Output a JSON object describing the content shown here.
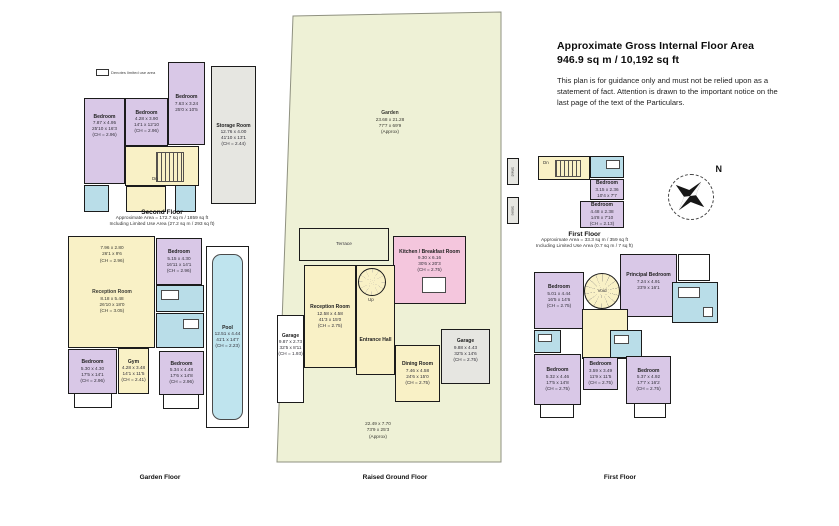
{
  "header": {
    "title_line1": "Approximate Gross Internal Floor Area",
    "title_line2": "946.9 sq m / 10,192 sq ft",
    "disclaimer": "This plan is for guidance only and must not be relied upon as a statement of fact. Attention is drawn to the important notice on the last page of the text of the Particulars."
  },
  "legend": {
    "label": "Denotes limited use area"
  },
  "compass": {
    "north": "N"
  },
  "colors": {
    "bedroom": "#d9c8e7",
    "living": "#f9f1c6",
    "bathroom": "#b9dde8",
    "kitchen": "#f4c6dd",
    "garden": "#eef1d6",
    "storage": "#e6e6e1",
    "pool": "#bfe4ee",
    "wall": "#1b1b1b"
  },
  "floors": {
    "second_floor": {
      "title": "Second Floor",
      "area1": "Approximate Area = 172.7 sq m / 1859 sq ft",
      "area2": "Including Limited Use Area (27.2 sq m / 293 sq ft)",
      "rooms": {
        "bedroom_left": {
          "name": "Bedroom",
          "metric": "7.87 x 4.95",
          "imperial": "25'10 x 16'3",
          "ch": "(CH = 2.96)"
        },
        "bedroom_mid": {
          "name": "Bedroom",
          "metric": "4.28 x 3.90",
          "imperial": "14'1 x 12'10",
          "ch": "(CH = 2.96)"
        },
        "bedroom_right": {
          "name": "Bedroom",
          "metric": "7.63 x 3.24",
          "imperial": "25'0 x 10'5"
        },
        "storage": {
          "name": "Storage Room",
          "metric": "12.76 x 4.00",
          "imperial": "41'10 x 13'1",
          "ch": "(CH = 2.44)"
        },
        "stairs_dn": "Dn"
      }
    },
    "garden_floor": {
      "title": "Garden Floor",
      "rooms": {
        "front_room": {
          "metric": "7.96 x 2.80",
          "imperial": "26'1 x 9'6",
          "ch": "(CH = 2.96)"
        },
        "reception": {
          "name": "Reception Room",
          "metric": "8.18 x 5.48",
          "imperial": "26'10 x 18'0",
          "ch": "(CH = 3.05)"
        },
        "bedroom_top": {
          "name": "Bedroom",
          "metric": "5.15 x 4.30",
          "imperial": "16'11 x 14'1",
          "ch": "(CH = 2.96)"
        },
        "pool": {
          "name": "Pool",
          "metric": "12.51 x 4.44",
          "imperial": "41'1 x 14'7",
          "ch": "(CH = 2.23)"
        },
        "bedroom_left": {
          "name": "Bedroom",
          "metric": "5.30 x 4.30",
          "imperial": "17'5 x 14'1",
          "ch": "(CH = 2.96)"
        },
        "gym": {
          "name": "Gym",
          "metric": "4.28 x 3.48",
          "imperial": "14'1 x 11'5",
          "ch": "(CH = 2.41)"
        },
        "bedroom_right": {
          "name": "Bedroom",
          "metric": "5.34 x 4.48",
          "imperial": "17'6 x 14'8",
          "ch": "(CH = 2.96)"
        }
      }
    },
    "raised_ground_floor": {
      "title": "Raised Ground Floor",
      "garden": {
        "name": "Garden",
        "metric": "23.68 x 21.28",
        "imperial": "77'7 x 69'9",
        "approx": "(Approx)"
      },
      "front_garden": {
        "metric": "22.49 x 7.70",
        "imperial": "73'9 x 25'3",
        "approx": "(Approx)"
      },
      "rooms": {
        "terrace": {
          "name": "Terrace"
        },
        "kitchen": {
          "name": "Kitchen / Breakfast Room",
          "metric": "9.30 x 6.16",
          "imperial": "30'6 x 20'3",
          "ch": "(CH = 2.75)"
        },
        "reception": {
          "name": "Reception Room",
          "metric": "12.58 x 4.58",
          "imperial": "41'3 x 15'0",
          "ch": "(CH = 2.75)"
        },
        "entrance_hall": {
          "name": "Entrance Hall"
        },
        "dining": {
          "name": "Dining Room",
          "metric": "7.46 x 4.58",
          "imperial": "24'6 x 15'0",
          "ch": "(CH = 2.75)"
        },
        "garage_left": {
          "name": "Garage",
          "metric": "9.87 x 2.73",
          "imperial": "32'5 x 8'11",
          "ch": "(CH = 1.93)"
        },
        "garage_right": {
          "name": "Garage",
          "metric": "9.88 x 4.43",
          "imperial": "32'5 x 14'6",
          "ch": "(CH = 2.75)"
        },
        "stairs_up": "Up"
      }
    },
    "first_floor_annex": {
      "title": "First Floor",
      "area1": "Approximate Area = 33.3 sq m / 359 sq ft",
      "area2": "Including Limited Use Area (0.7 sq m / 7 sq ft)",
      "rooms": {
        "bedroom_small": {
          "name": "Bedroom",
          "metric": "3.15 x 2.36",
          "imperial": "10'4 x 7'7"
        },
        "bedroom_large": {
          "name": "Bedroom",
          "metric": "4.48 x 2.38",
          "imperial": "14'8 x 7'10",
          "ch": "(CH = 2.13)"
        },
        "stairs_dn": "Dn",
        "shed": "Shed",
        "store": "Store"
      }
    },
    "first_floor": {
      "title": "First Floor",
      "rooms": {
        "bedroom_nw": {
          "name": "Bedroom",
          "metric": "5.01 x 4.44",
          "imperial": "16'5 x 14'6",
          "ch": "(CH = 2.75)"
        },
        "principal": {
          "name": "Principal Bedroom",
          "metric": "7.24 x 4.91",
          "imperial": "23'9 x 16'1"
        },
        "void": "Void",
        "bedroom_sw": {
          "name": "Bedroom",
          "metric": "5.32 x 4.46",
          "imperial": "17'5 x 14'8",
          "ch": "(CH = 2.75)"
        },
        "bedroom_s": {
          "name": "Bedroom",
          "metric": "3.59 x 3.49",
          "imperial": "11'9 x 11'5",
          "ch": "(CH = 2.75)"
        },
        "bedroom_se": {
          "name": "Bedroom",
          "metric": "5.37 x 4.92",
          "imperial": "17'7 x 16'2",
          "ch": "(CH = 2.75)"
        }
      }
    }
  }
}
